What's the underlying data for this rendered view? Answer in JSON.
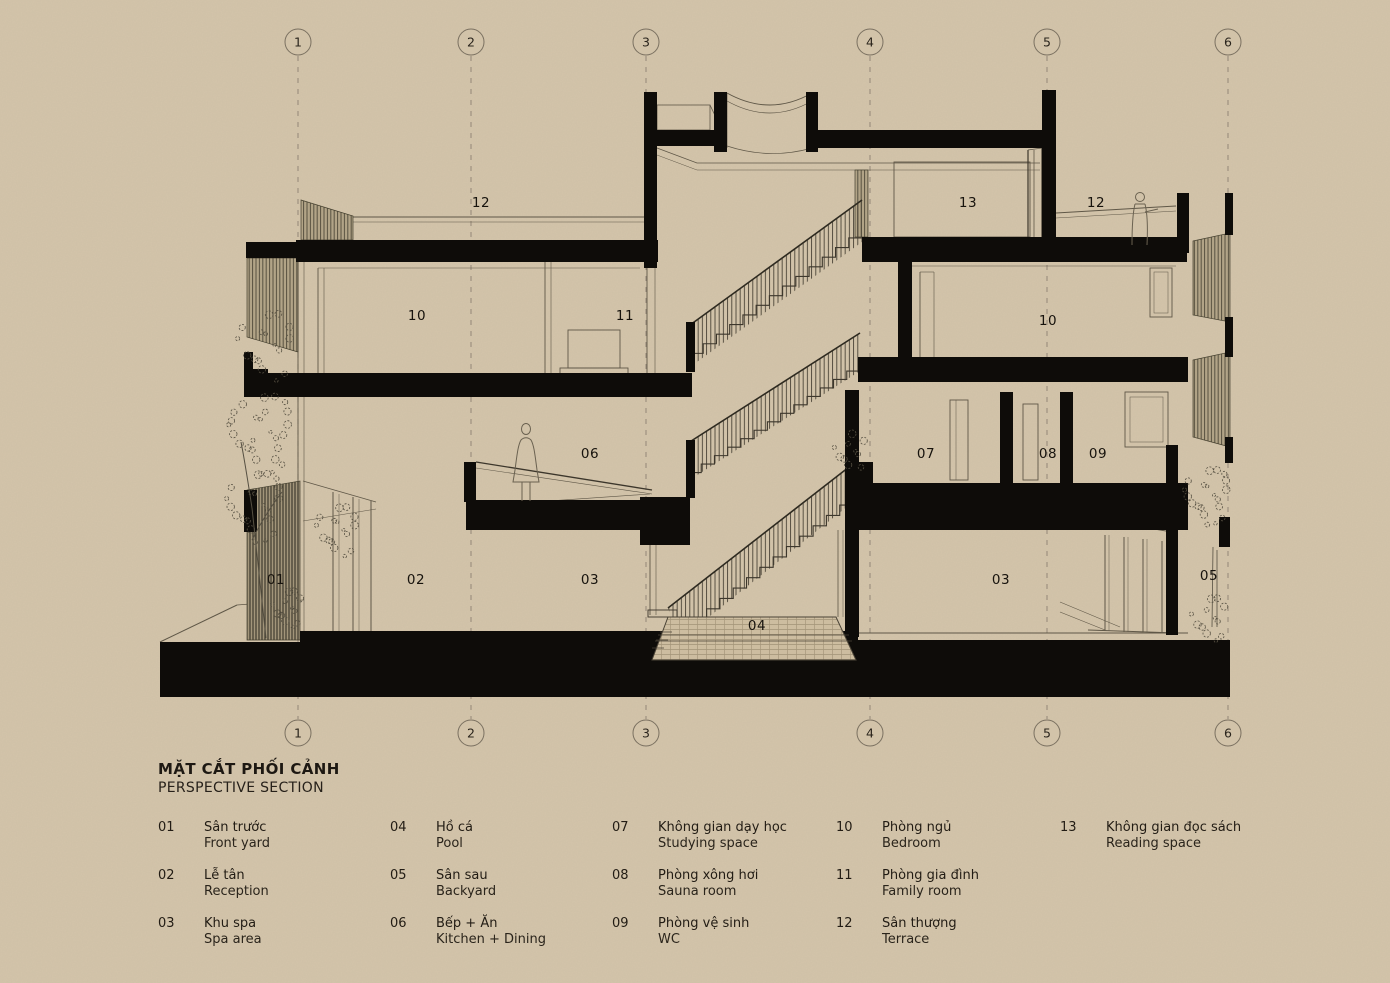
{
  "page": {
    "title_vi": "MẶT CẮT PHỐI CẢNH",
    "title_en": "PERSPECTIVE SECTION"
  },
  "colors": {
    "paper": "#d4c5ab",
    "ink": "#14100b",
    "line": "#5c5444",
    "hatch": "#6e6452",
    "grid": "#8d8172",
    "poche": "#0e0c09"
  },
  "grid": {
    "labels": [
      "1",
      "2",
      "3",
      "4",
      "5",
      "6"
    ],
    "x": [
      298,
      471,
      646,
      870,
      1047,
      1228
    ],
    "circle_top_y": 42,
    "circle_bottom_y": 733,
    "radius": 13,
    "line_top": 56,
    "line_bottom": 719
  },
  "room_labels": [
    {
      "text": "12",
      "x": 481,
      "y": 207
    },
    {
      "text": "13",
      "x": 968,
      "y": 207
    },
    {
      "text": "12",
      "x": 1096,
      "y": 207
    },
    {
      "text": "10",
      "x": 417,
      "y": 320
    },
    {
      "text": "11",
      "x": 625,
      "y": 320
    },
    {
      "text": "10",
      "x": 1048,
      "y": 325
    },
    {
      "text": "06",
      "x": 590,
      "y": 458
    },
    {
      "text": "07",
      "x": 926,
      "y": 458
    },
    {
      "text": "08",
      "x": 1048,
      "y": 458
    },
    {
      "text": "09",
      "x": 1098,
      "y": 458
    },
    {
      "text": "01",
      "x": 276,
      "y": 584
    },
    {
      "text": "02",
      "x": 416,
      "y": 584
    },
    {
      "text": "03",
      "x": 590,
      "y": 584
    },
    {
      "text": "03",
      "x": 1001,
      "y": 584
    },
    {
      "text": "05",
      "x": 1209,
      "y": 580
    },
    {
      "text": "04",
      "x": 757,
      "y": 630
    }
  ],
  "legend": {
    "columns": [
      {
        "x": 158,
        "items": [
          {
            "num": "01",
            "vi": "Sân trước",
            "en": "Front yard"
          },
          {
            "num": "02",
            "vi": "Lễ tân",
            "en": "Reception"
          },
          {
            "num": "03",
            "vi": "Khu spa",
            "en": "Spa area"
          }
        ]
      },
      {
        "x": 390,
        "items": [
          {
            "num": "04",
            "vi": "Hồ cá",
            "en": "Pool"
          },
          {
            "num": "05",
            "vi": "Sân sau",
            "en": "Backyard"
          },
          {
            "num": "06",
            "vi": "Bếp + Ăn",
            "en": "Kitchen + Dining"
          }
        ]
      },
      {
        "x": 612,
        "items": [
          {
            "num": "07",
            "vi": "Không gian dạy học",
            "en": "Studying space"
          },
          {
            "num": "08",
            "vi": "Phòng xông hơi",
            "en": "Sauna room"
          },
          {
            "num": "09",
            "vi": "Phòng vệ sinh",
            "en": "WC"
          }
        ]
      },
      {
        "x": 836,
        "items": [
          {
            "num": "10",
            "vi": "Phòng ngủ",
            "en": "Bedroom"
          },
          {
            "num": "11",
            "vi": "Phòng gia đình",
            "en": "Family room"
          },
          {
            "num": "12",
            "vi": "Sân thượng",
            "en": "Terrace"
          }
        ]
      },
      {
        "x": 1060,
        "items": [
          {
            "num": "13",
            "vi": "Không gian đọc sách",
            "en": "Reading space"
          }
        ]
      }
    ]
  }
}
